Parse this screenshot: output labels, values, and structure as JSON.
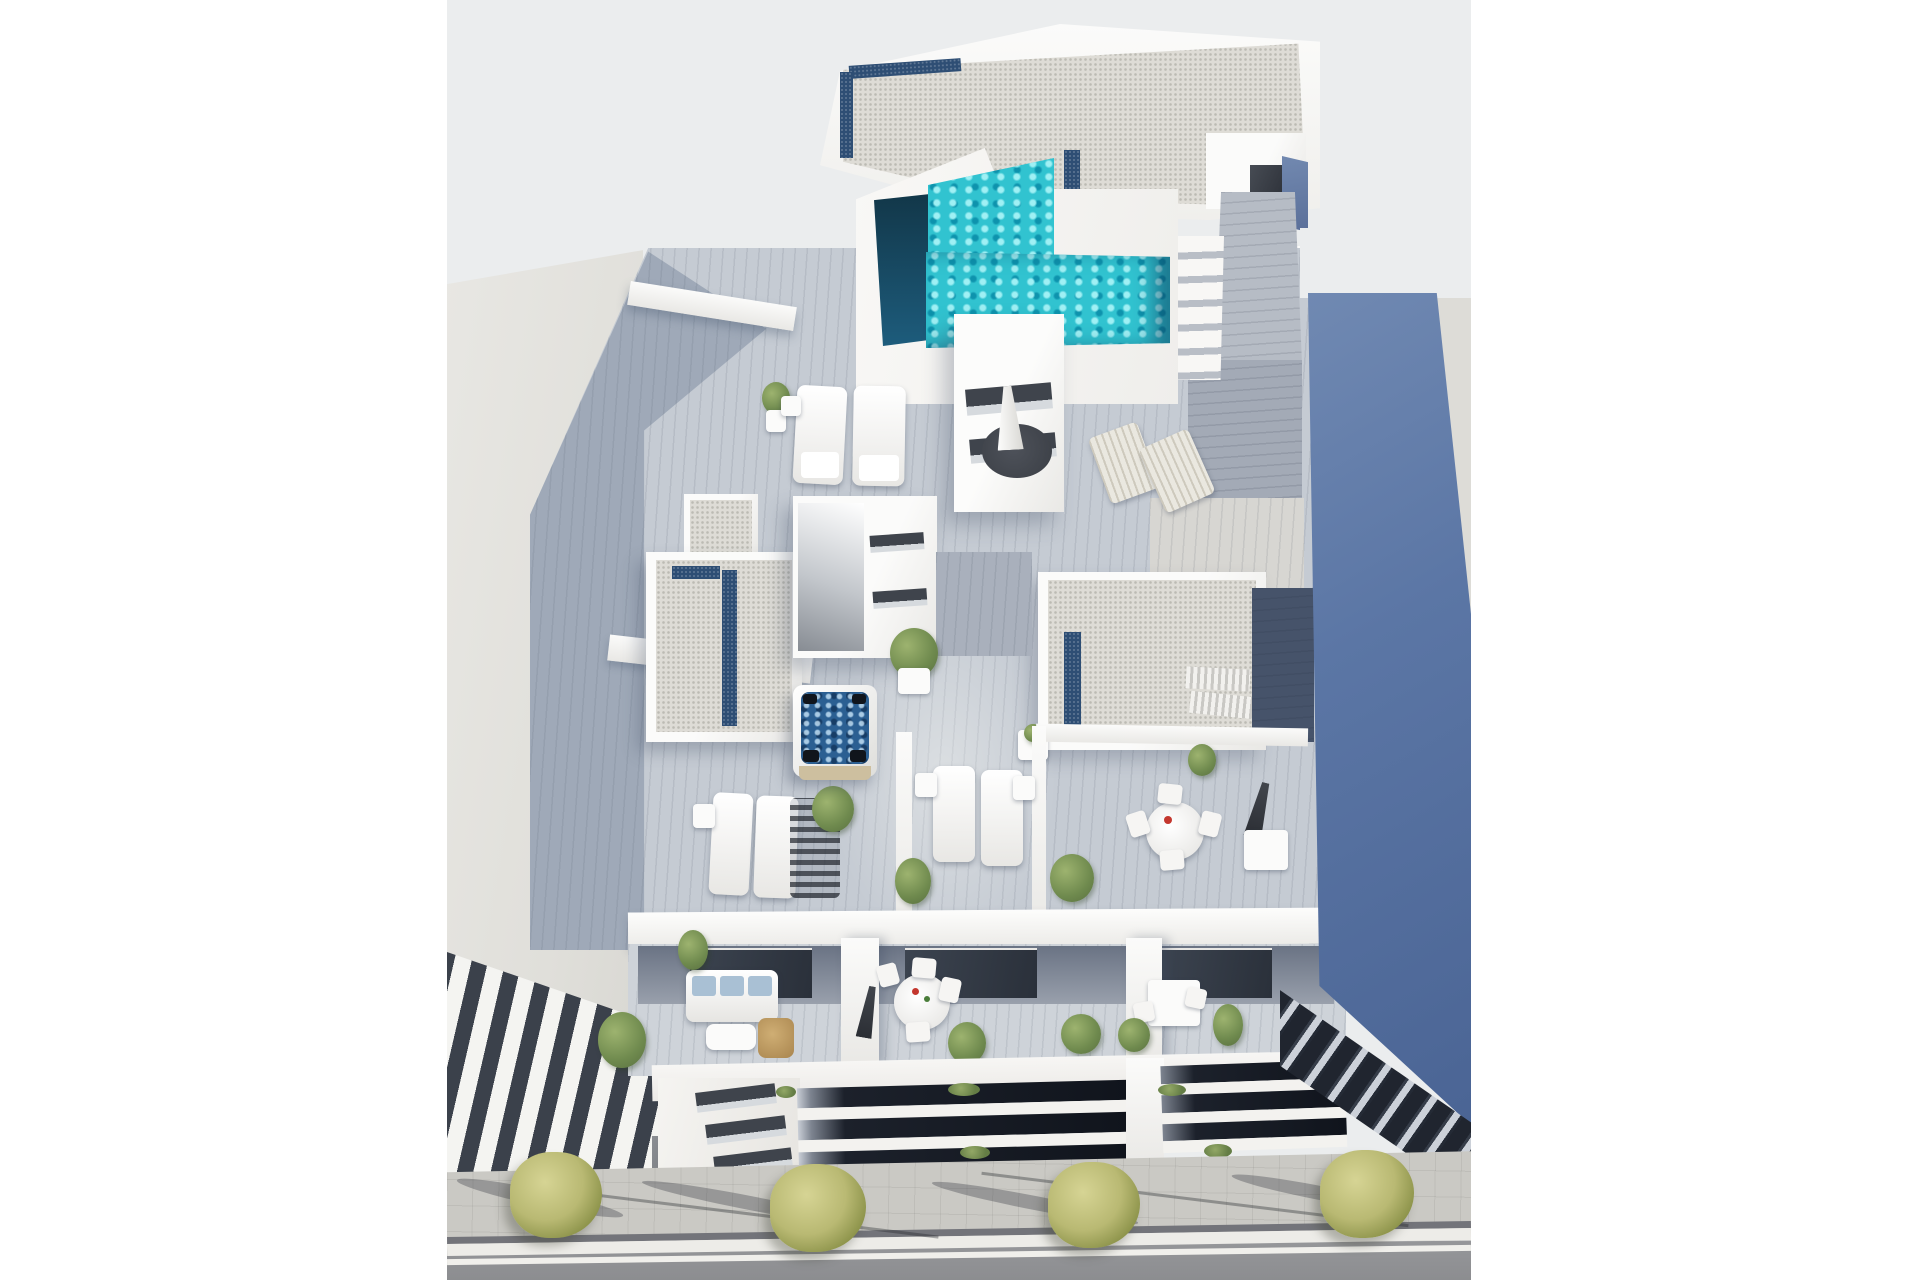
{
  "meta": {
    "title": "Aerial 3D architectural rendering",
    "description": "Aerial 3D render of a modern white apartment building with an L-shaped turquoise rooftop pool, gravel roof decks with navy skylights, wood-plank terraces furnished with white sun loungers, parasols, a jacuzzi and dining sets, recessed balconies with outdoor sofas, a slate-blue flat roof of the right neighbor building, a beige neighbor building on the left, and a sidewalk with yellow-green street trees beside an asphalt road.",
    "image_width_px": 1920,
    "image_height_px": 1280,
    "visible_text": "none"
  },
  "palette": {
    "page_bg": "#ffffff",
    "backdrop": "#ebedee",
    "white_hi": "#fbfbfa",
    "white_mid": "#f3f2f0",
    "white_shade": "#e9e8e5",
    "beige_wall": "#e3e2de",
    "beige_dark": "#d6d5d0",
    "gravel": "#dedcd6",
    "skylight_navy": "#2e4e74",
    "pool_teal": "#31c3d0",
    "pool_teal_light": "#9ff0f4",
    "pool_teal_deep": "#0e93ad",
    "pool_navy": "#123749",
    "deck": "#c5cbd3",
    "deck_shade": "#8e9aad",
    "blue_roof": "#5b76a5",
    "blue_roof_light": "#7089b2",
    "blue_roof_dark": "#4a6494",
    "dark_glass": "#20252f",
    "glass_stripe": "#ccd1d9",
    "stripe_dark": "#3b414b",
    "stripe_white": "#f4f4f1",
    "sidewalk": "#cac9c4",
    "road": "#96979a",
    "curb": "#edece8",
    "tree": "#b9b973",
    "tree_light": "#d6d494",
    "tree_dark": "#8a9148",
    "foliage": "#6f8a4e",
    "jacuzzi": "#2b5f92",
    "jacuzzi_deep": "#173d66",
    "wood_tan": "#cdbf9f",
    "wicker": "#b08c52",
    "cushion": "#a9c0d4",
    "metal_dark": "#2b2e34"
  },
  "scene": {
    "buildings": {
      "main": {
        "label": "main-apartment-building",
        "features": [
          "white gravel flat roof",
          "navy skylight strips",
          "l-shaped turquoise rooftop pool",
          "pool access stairs",
          "stair bulkheads with slot windows",
          "plank walkways",
          "roof terraces with wood decking",
          "jacuzzi hot tub",
          "white sun loungers",
          "closed parasols",
          "potted plants",
          "round and square dining sets",
          "outdoor sofa with blue cushions",
          "recessed balcony rows",
          "louvered facade slots"
        ]
      },
      "left_neighbor": {
        "label": "left-neighbor-building",
        "features": [
          "plain beige wall",
          "diagonal white balcony slabs with dark voids",
          "stone corner pier"
        ]
      },
      "right_neighbor": {
        "label": "right-neighbor-building",
        "features": [
          "slate blue flat roof",
          "beige parapet strip",
          "dark glazed facade with light slab stripes",
          "blue stair bulkhead"
        ]
      }
    },
    "street": {
      "label": "street-level",
      "features": [
        "paved sidewalk with grid joints",
        "four yellow-green street trees",
        "long tree and cable shadows",
        "white curb band",
        "asphalt road with white edge line"
      ]
    }
  }
}
